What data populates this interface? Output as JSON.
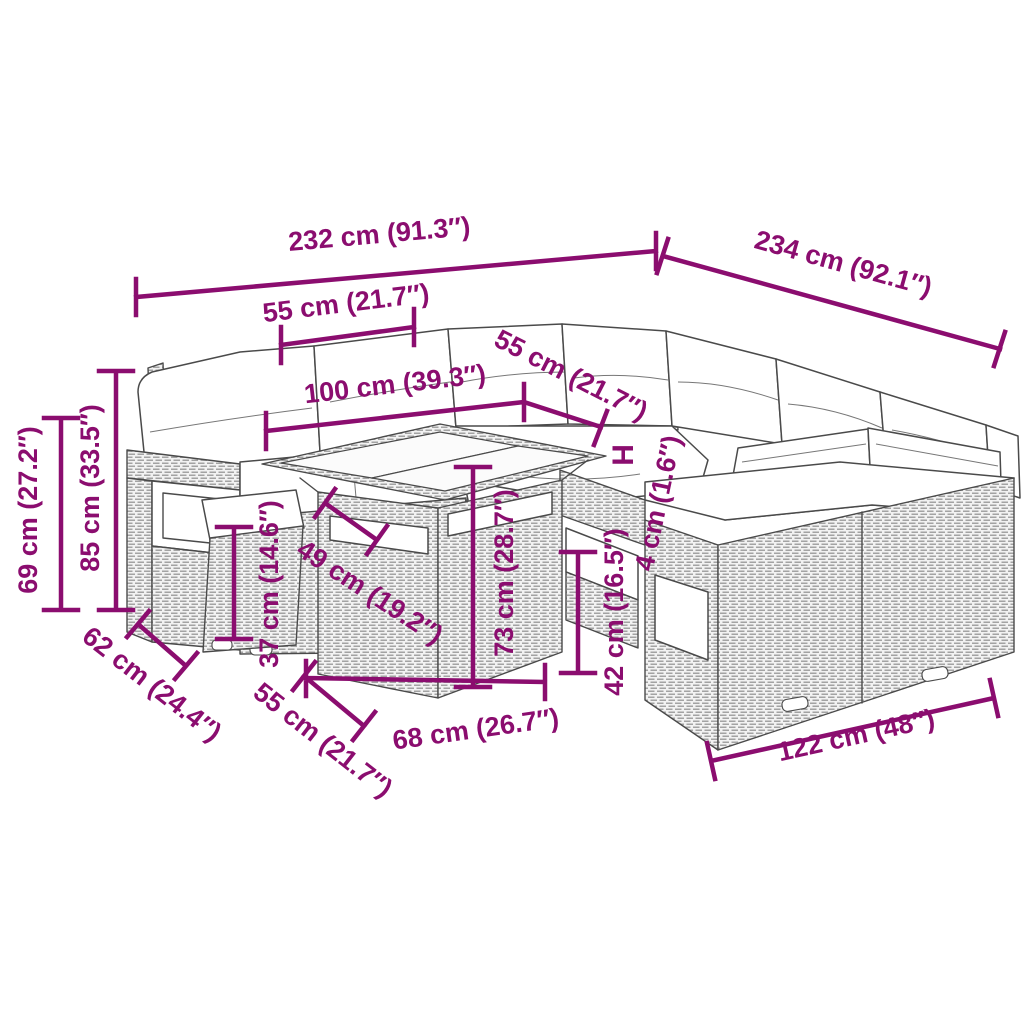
{
  "diagram": {
    "type": "product-dimension-diagram",
    "subject": "rattan garden lounge corner sofa set with table and footstools",
    "accent_color": "#8b0d6f",
    "art_line_color": "#4a4a4a",
    "dimensions": {
      "overall_width": "232 cm (91.3″)",
      "overall_depth": "234 cm (92.1″)",
      "seat_width_top": "55 cm (21.7″)",
      "tabletop_length": "100 cm (39.3″)",
      "seat_depth_top": "55 cm (21.7″)",
      "height_marker": "H",
      "cushion_thickness": "4 cm (1.6″)",
      "armrest_height": "69 cm (27.2″)",
      "backrest_height": "85 cm (33.5″)",
      "footstool_height": "37 cm (14.6″)",
      "table_depth": "49 cm (19.2″)",
      "table_height": "73 cm (28.7″)",
      "table_width": "68 cm (26.7″)",
      "footstool_width": "55 cm (21.7″)",
      "sofa_depth": "62 cm (24.4″)",
      "seat_height": "42 cm (16.5″)",
      "sofa_length": "122 cm (48″)"
    }
  }
}
